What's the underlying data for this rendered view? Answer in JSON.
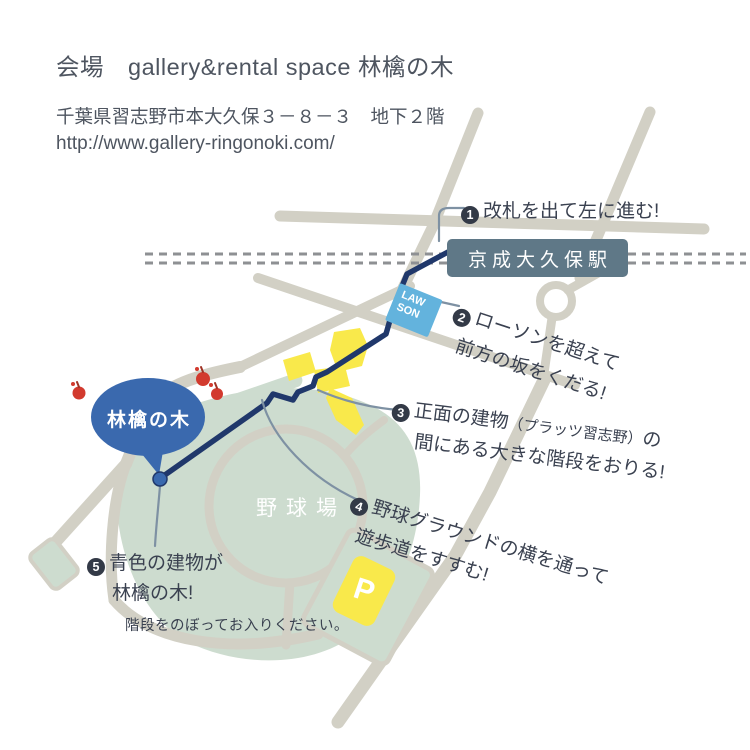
{
  "header": {
    "title": "会場　gallery&rental space 林檎の木",
    "address": "千葉県習志野市本大久保３－８－３　地下２階",
    "url": "http://www.gallery-ringonoki.com/"
  },
  "map": {
    "station": {
      "label": "京成大久保駅"
    },
    "lawson": {
      "line1": "LAW",
      "line2": "SON"
    },
    "bubble": {
      "label": "林檎の木"
    },
    "ballpark": {
      "label": "野球場"
    },
    "parking": {
      "label": "P"
    },
    "steps": [
      {
        "num": "1",
        "text": "改札を出て左に進む!"
      },
      {
        "num": "2",
        "line1": "ローソンを超えて",
        "line2": "前方の坂をくだる!"
      },
      {
        "num": "3",
        "line1_pre": "正面の建物",
        "line1_paren": "（プラッツ習志野）",
        "line1_post": "の",
        "line2": "間にある大きな階段をおりる!"
      },
      {
        "num": "4",
        "line1": "野球グラウンドの横を通って",
        "line2": "遊歩道をすすむ!"
      },
      {
        "num": "5",
        "line1": "青色の建物が",
        "line2": "林檎の木!",
        "line3": "階段をのぼってお入りください。"
      }
    ],
    "colors": {
      "route_navy": "#20386b",
      "road_beige": "#d2d0c5",
      "park_green": "#cddccf",
      "building_yellow": "#f9e94b",
      "station_bg": "#5f7887",
      "lawson_blue": "#63b3dd",
      "bubble_blue": "#3a69ae",
      "apple_red": "#d23a2e",
      "railroad_gray": "#8e9093",
      "leader_slate": "#7e91a3",
      "text_dark": "#3a4150",
      "header_text": "#4e5560"
    }
  }
}
